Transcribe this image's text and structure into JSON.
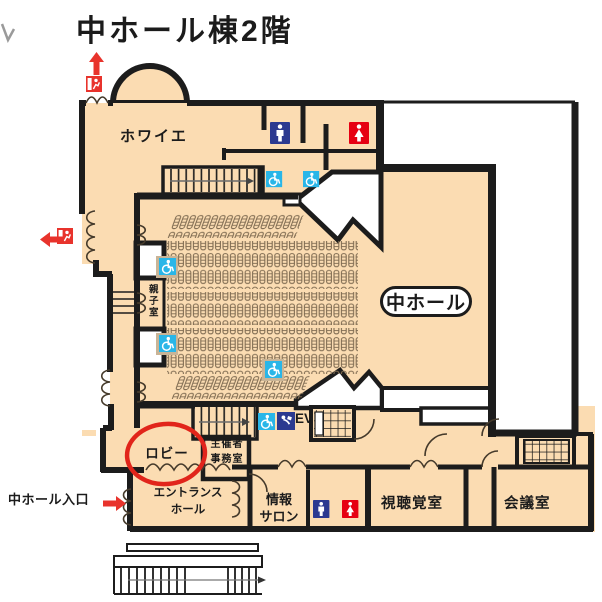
{
  "title": "中ホール棟2階",
  "rooms": {
    "foyer": "ホワイエ",
    "hall": "中ホール",
    "parent_child_room": "親子室",
    "lobby": "ロビー",
    "organizer_office": "主催者\n事務室",
    "elevator": "EV",
    "entrance_hall": "エントランス\nホール",
    "info_salon": "情報\nサロン",
    "av_room": "視聴覚室",
    "meeting_room": "会議室"
  },
  "annotations": {
    "hall_entrance": "中ホール入口"
  },
  "icons": [
    {
      "name": "emergency-exit-icon",
      "color": "#e8332c"
    },
    {
      "name": "male-restroom-icon",
      "color": "#2b3990"
    },
    {
      "name": "female-restroom-icon",
      "color": "#e60012"
    },
    {
      "name": "wheelchair-accessible-icon",
      "color": "#29b6e8"
    },
    {
      "name": "multipurpose-toilet-icon",
      "color": "#2b3990"
    }
  ],
  "colors": {
    "floor": "#fbdcb2",
    "wall": "#1c1c1c",
    "highlight_red": "#e8332c",
    "seat_outline": "#806c52"
  }
}
